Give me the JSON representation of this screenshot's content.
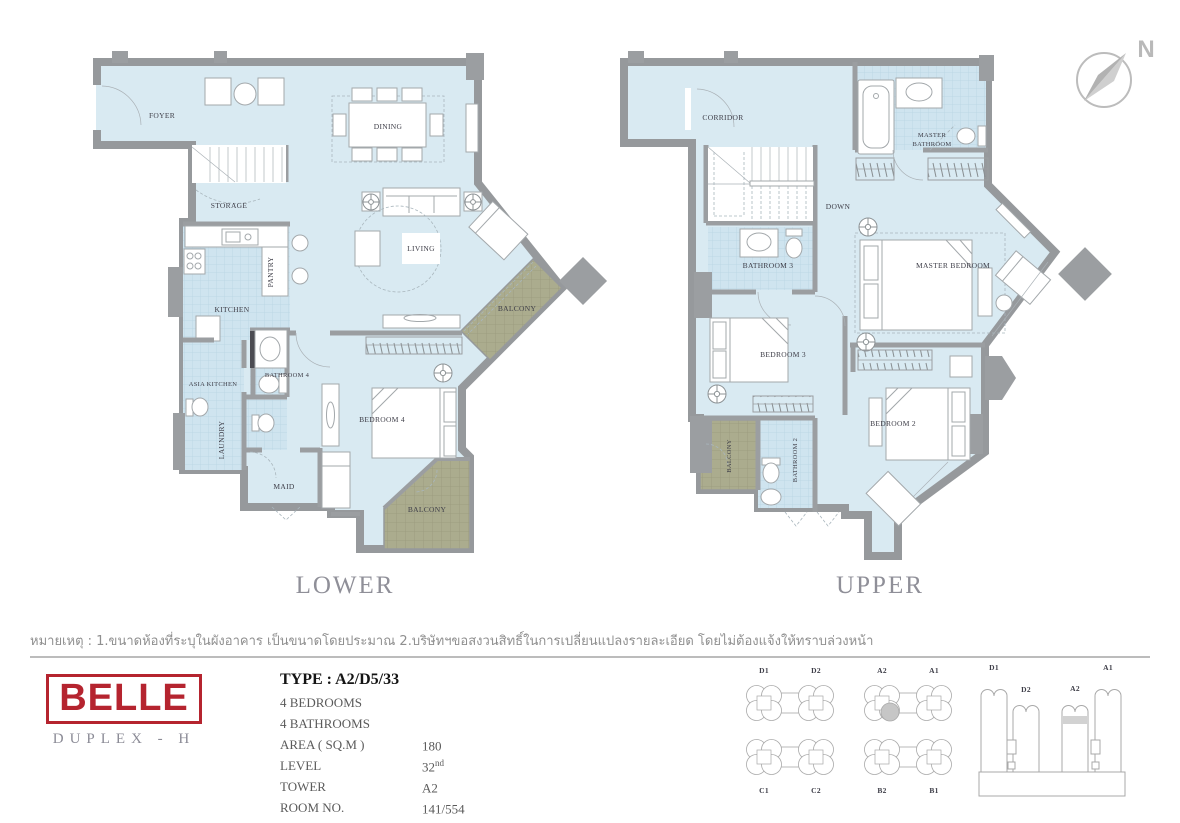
{
  "compass": {
    "label": "N"
  },
  "plans": {
    "lower": {
      "title": "LOWER",
      "rooms": {
        "foyer": "FOYER",
        "dining": "DINING",
        "storage": "STORAGE",
        "pantry": "PANTRY",
        "kitchen": "KITCHEN",
        "living": "LIVING",
        "balcony_side": "BALCONY",
        "asia_kitchen": "ASIA KITCHEN",
        "bathroom4": "BATHROOM 4",
        "laundry": "LAUNDRY",
        "maid": "MAID",
        "bedroom4": "BEDROOM 4",
        "balcony_bottom": "BALCONY"
      }
    },
    "upper": {
      "title": "UPPER",
      "rooms": {
        "corridor": "CORRIDOR",
        "down": "DOWN",
        "master_bathroom_line1": "MASTER",
        "master_bathroom_line2": "BATHROOM",
        "bathroom3": "BATHROOM 3",
        "master_bedroom": "MASTER BEDROOM",
        "bedroom3": "BEDROOM 3",
        "balcony": "BALCONY",
        "bathroom2": "BATHROOM 2",
        "bedroom2": "BEDROOM 2"
      }
    }
  },
  "note": "หมายเหตุ : 1.ขนาดห้องที่ระบุในผังอาคาร เป็นขนาดโดยประมาณ 2.บริษัทฯขอสงวนสิทธิ์ในการเปลี่ยนแปลงรายละเอียด โดยไม่ต้องแจ้งให้ทราบล่วงหน้า",
  "brand": {
    "name": "BELLE",
    "subtitle": "DUPLEX - H"
  },
  "details": {
    "type": "TYPE : A2/D5/33",
    "bedrooms": "4 BEDROOMS",
    "bathrooms": "4 BATHROOMS",
    "rows": [
      {
        "label": "AREA ( SQ.M )",
        "value": "180"
      },
      {
        "label": "LEVEL",
        "value": "32",
        "suffix": "nd"
      },
      {
        "label": "TOWER",
        "value": "A2"
      },
      {
        "label": "ROOM NO.",
        "value": "141/554"
      }
    ]
  },
  "keyplan": {
    "labels": {
      "d1": "D1",
      "d2": "D2",
      "a2": "A2",
      "a1": "A1",
      "c1": "C1",
      "c2": "C2",
      "b2": "B2",
      "b1": "B1"
    }
  },
  "elevation": {
    "labels": {
      "d1": "D1",
      "d2": "D2",
      "a2": "A2",
      "a1": "A1"
    }
  },
  "colors": {
    "accent_red": "#b5242f",
    "floor_blue": "#d9eaf2",
    "wall_gray": "#9b9ea1",
    "balcony_olive": "#abac8e"
  }
}
